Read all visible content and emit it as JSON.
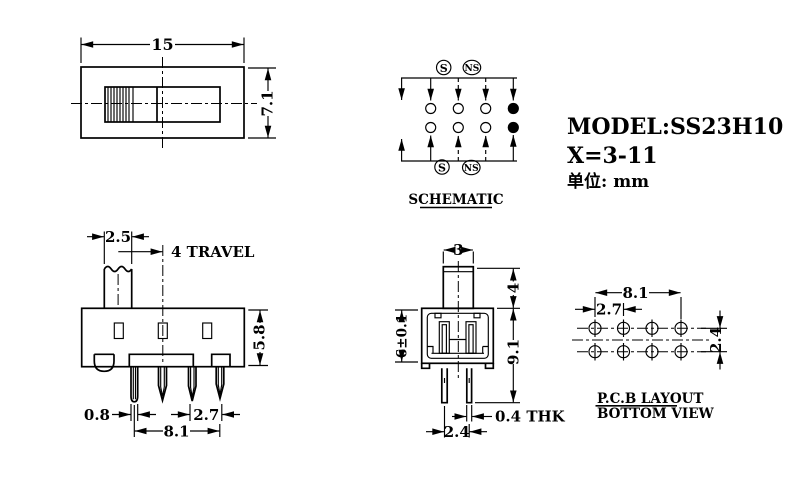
{
  "colors": {
    "line": "#000000",
    "background": "#ffffff",
    "text": "#000000"
  },
  "info": {
    "model": "MODEL:SS23H10",
    "x_range": "X=3-11",
    "unit": "单位: mm"
  },
  "top_view": {
    "width_dim": "15",
    "height_dim": "7.1"
  },
  "schematic": {
    "label": "SCHEMATIC",
    "s_top": "S",
    "ns_top": "NS",
    "s_bottom": "S",
    "ns_bottom": "NS"
  },
  "front_view": {
    "knob_width_dim": "2.5",
    "travel_dim": "4 TRAVEL",
    "body_height_dim": "5.8",
    "pin_width_dim": "0.8",
    "pin_pitch_dim": "2.7",
    "pin_span_dim": "8.1"
  },
  "side_view": {
    "knob_width_dim": "3",
    "knob_height_dim": "4",
    "body_height_dim": "6±0.1",
    "total_height_dim": "9.1",
    "pin_thickness_dim": "0.4 THK",
    "pin_pitch_dim": "2.4"
  },
  "pcb_layout": {
    "span_dim": "8.1",
    "pitch_dim": "2.7",
    "row_pitch_dim": "2.4",
    "title": "P.C.B LAYOUT",
    "subtitle": "BOTTOM VIEW"
  }
}
